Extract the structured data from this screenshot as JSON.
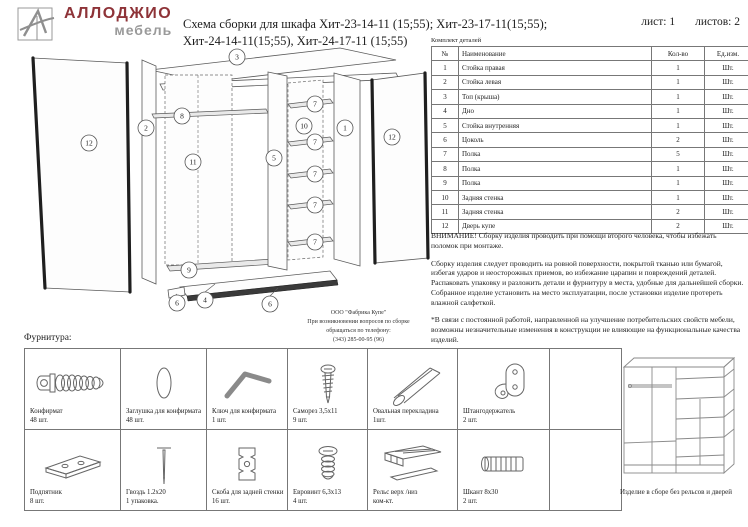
{
  "colors": {
    "brand_red": "#8e3338",
    "brand_gray": "#9a9a9a"
  },
  "header": {
    "brand": "АЛЛОДЖИО",
    "brand_sub": "мебель",
    "title_line1": "Схема сборки для шкафа Хит-23-14-11 (15;55); Хит-23-17-11(15;55);",
    "title_line2": "Хит-24-14-11(15;55), Хит-24-17-11 (15;55)",
    "sheet": "лист: 1",
    "sheets": "листов: 2"
  },
  "parts_table": {
    "caption": "Комплект деталей",
    "columns": [
      "№",
      "Наименование",
      "Кол-во",
      "Ед.изм."
    ],
    "rows": [
      [
        "1",
        "Стойка правая",
        "1",
        "Шт."
      ],
      [
        "2",
        "Стойка левая",
        "1",
        "Шт."
      ],
      [
        "3",
        "Топ (крыша)",
        "1",
        "Шт."
      ],
      [
        "4",
        "Дно",
        "1",
        "Шт."
      ],
      [
        "5",
        "Стойка внутренняя",
        "1",
        "Шт."
      ],
      [
        "6",
        "Цоколь",
        "2",
        "Шт."
      ],
      [
        "7",
        "Полка",
        "5",
        "Шт."
      ],
      [
        "8",
        "Полка",
        "1",
        "Шт."
      ],
      [
        "9",
        "Полка",
        "1",
        "Шт."
      ],
      [
        "10",
        "Задняя стенка",
        "1",
        "Шт."
      ],
      [
        "11",
        "Задняя стенка",
        "2",
        "Шт."
      ],
      [
        "12",
        "Дверь купе",
        "2",
        "Шт."
      ]
    ]
  },
  "notices": {
    "warning": "ВНИМАНИЕ! Сборку изделия проводить при помощи второго человека, чтобы избежать поломок при монтаже.",
    "assembly_1": "Сборку изделия следует проводить на ровной поверхности, покрытой тканью или бумагой, избегая ударов и неосторожных приемов, во избежание царапин и повреждений деталей.",
    "assembly_2": "Распаковать упаковку и разложить детали и фурнитуру в места, удобные для дальнейшей сборки.",
    "assembly_3": "Собранное изделие установить на место эксплуатации, после установки изделие протереть влажной салфеткой.",
    "disclaimer": "*В связи с постоянной работой, направленной на улучшение потребительских свойств мебели, возможны незначительные изменения в конструкции не влияющие на функциональные качества изделий."
  },
  "diagram": {
    "callout_numbers": [
      "1",
      "2",
      "3",
      "4",
      "5",
      "6",
      "7",
      "8",
      "9",
      "10",
      "11",
      "12"
    ]
  },
  "manufacturer": {
    "line1": "ООО \"Фабрика Купе\"",
    "line2": "При возникновении вопросов по сборке",
    "line3": "обращаться по телефону:",
    "line4": "(343) 285-00-95 (96)"
  },
  "hardware": {
    "section_title": "Фурнитура:",
    "items": [
      {
        "name": "Конфирмат",
        "qty": "48 шт.",
        "icon": "confirmat-screw-icon"
      },
      {
        "name": "Заглушка для конфирмата",
        "qty": "48 шт.",
        "icon": "cap-icon"
      },
      {
        "name": "Ключ для конфирмата",
        "qty": "1 шт.",
        "icon": "hex-key-icon"
      },
      {
        "name": "Саморез 3,5х11",
        "qty": "9 шт.",
        "icon": "self-tapping-screw-icon"
      },
      {
        "name": "Овальная перекладина",
        "qty": "1шт.",
        "icon": "oval-rod-icon"
      },
      {
        "name": "Штангодержатель",
        "qty": "2 шт.",
        "icon": "rod-holder-icon"
      },
      {
        "name": "Подпятник",
        "qty": "8 шт.",
        "icon": "foot-plate-icon"
      },
      {
        "name": "Гвоздь 1.2х20",
        "qty": "1 упаковка.",
        "icon": "nail-icon"
      },
      {
        "name": "Скоба для задней стенки",
        "qty": "16 шт.",
        "icon": "back-wall-bracket-icon"
      },
      {
        "name": "Евровинт 6,3х13",
        "qty": "4 шт.",
        "icon": "euro-screw-icon"
      },
      {
        "name": "Рельс верх /низ",
        "qty": "ком-кт.",
        "icon": "rail-icon"
      },
      {
        "name": "Шкант 8х30",
        "qty": "2 шт.",
        "icon": "dowel-icon"
      }
    ]
  },
  "assembled_view": {
    "caption": "Изделие в сборе без рельсов и дверей"
  }
}
